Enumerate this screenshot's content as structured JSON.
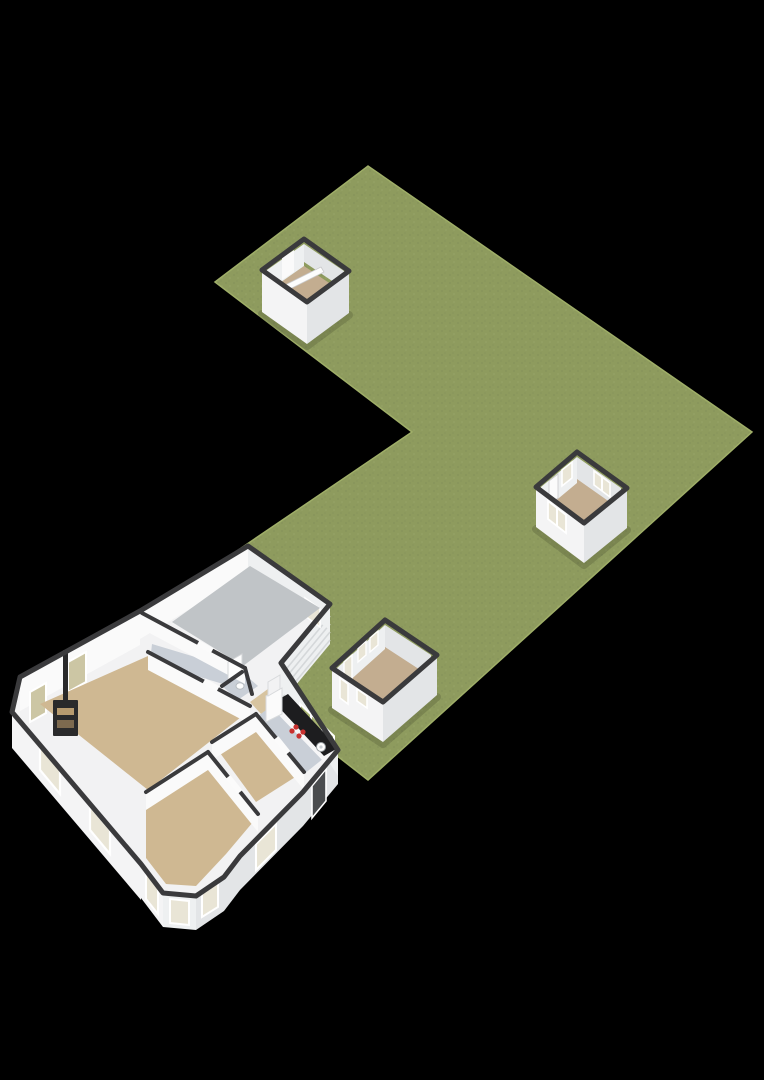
{
  "title": "3D floor plan of house with garden plot and outbuildings",
  "colors": {
    "background": "#000000",
    "grass": "#8e9b5e",
    "grass_dot": "#85925a",
    "grass_dot2": "#97a468",
    "grass_edge": "#9fae68",
    "wall_top": "#3a3a3c",
    "wall_white": "#f4f4f5",
    "wall_shade": "#e3e5e7",
    "wall_interior": "#eef0f1",
    "wall_light": "#fafafa",
    "floor_wood": "#cfb892",
    "floor_wood_light": "#d7c4a0",
    "floor_gray": "#c0c4c7",
    "floor_tile": "#c9cfd7",
    "floor_outbuilding": "#c3ad90",
    "counter_dark": "#1d1d1f",
    "counter_base": "#f6f6f7",
    "burner_red": "#c8302e",
    "sink_white": "#fdfdfd",
    "glass_olive": "#ccc6a4",
    "glass_green": "#a9b573",
    "glass_pale": "#e9e5d6",
    "door_dark": "#4a4c4e",
    "stove_black": "#2a2a2b",
    "stove_log_top": "#b79b6f",
    "stove_log_bottom": "#7d6a4f",
    "frame_white": "#ffffff"
  },
  "scene": {
    "plot": {
      "name": "L-shaped garden lawn"
    },
    "buildings": [
      {
        "name": "garden shed",
        "detail": "small open-top shed with ridge beam"
      },
      {
        "name": "guest room",
        "detail": "outbuilding with door and three windows"
      },
      {
        "name": "garden room",
        "detail": "outbuilding with multiple windows"
      },
      {
        "name": "main house",
        "rooms": [
          "garage",
          "hallway",
          "living room",
          "wc",
          "hall",
          "kitchen",
          "bedroom",
          "bay-window bedroom"
        ],
        "features": [
          "wood stove with flue",
          "kitchen counter with hob and sink",
          "slatted garage door",
          "bay window",
          "boiler cabinet"
        ]
      }
    ]
  }
}
